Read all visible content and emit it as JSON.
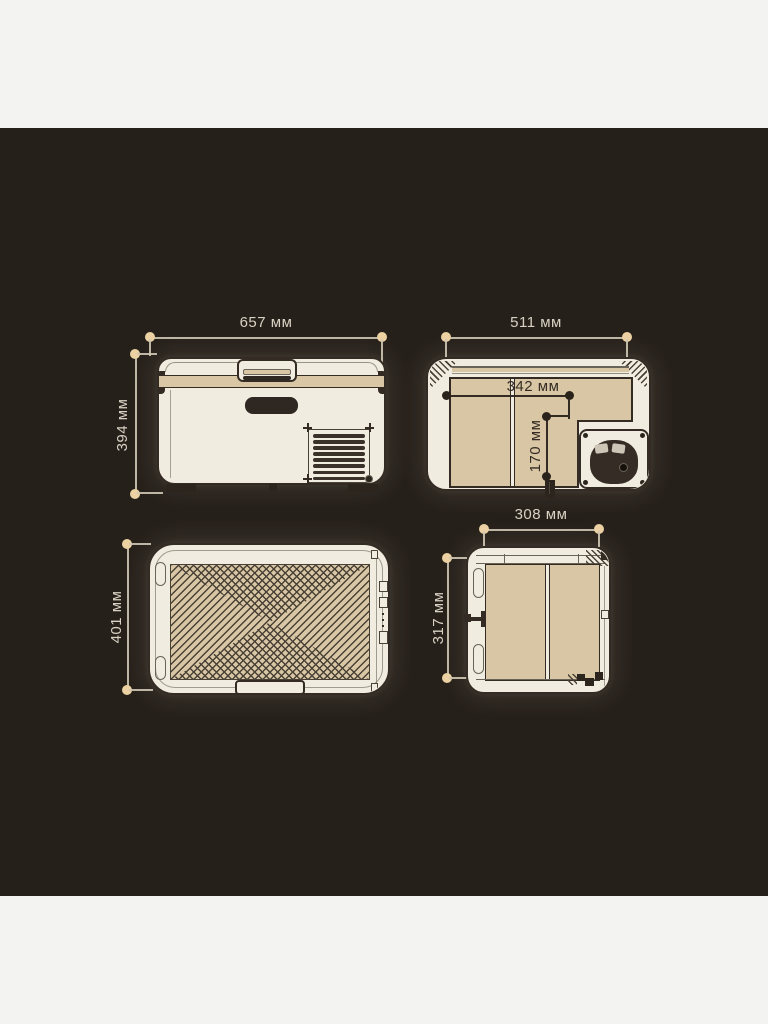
{
  "palette": {
    "page_bg": "#f3f3f2",
    "canvas_bg": "#26201a",
    "cream": "#f1ece0",
    "tan": "#d8c6a4",
    "ink": "#342c24",
    "hatch": "#4a4136",
    "line_soft": "#6a6458",
    "bumper": "#332b23",
    "dim_line": "#cfc7b4",
    "dim_dot": "#ecd1a3",
    "dot_dark": "#2a231c",
    "text_light": "#d9d2c4"
  },
  "units": "мм",
  "views": {
    "front": {
      "name": "front-view",
      "width_dim": "657 мм",
      "height_dim": "394 мм"
    },
    "top_open": {
      "name": "top-open-view",
      "width_dim": "511 мм",
      "inner_width_dim": "342 мм",
      "inner_depth_dim": "170 мм"
    },
    "lid_top": {
      "name": "lid-top-view",
      "depth_dim": "401 мм"
    },
    "side": {
      "name": "side-view",
      "width_dim": "308 мм",
      "height_dim": "317 мм"
    }
  }
}
